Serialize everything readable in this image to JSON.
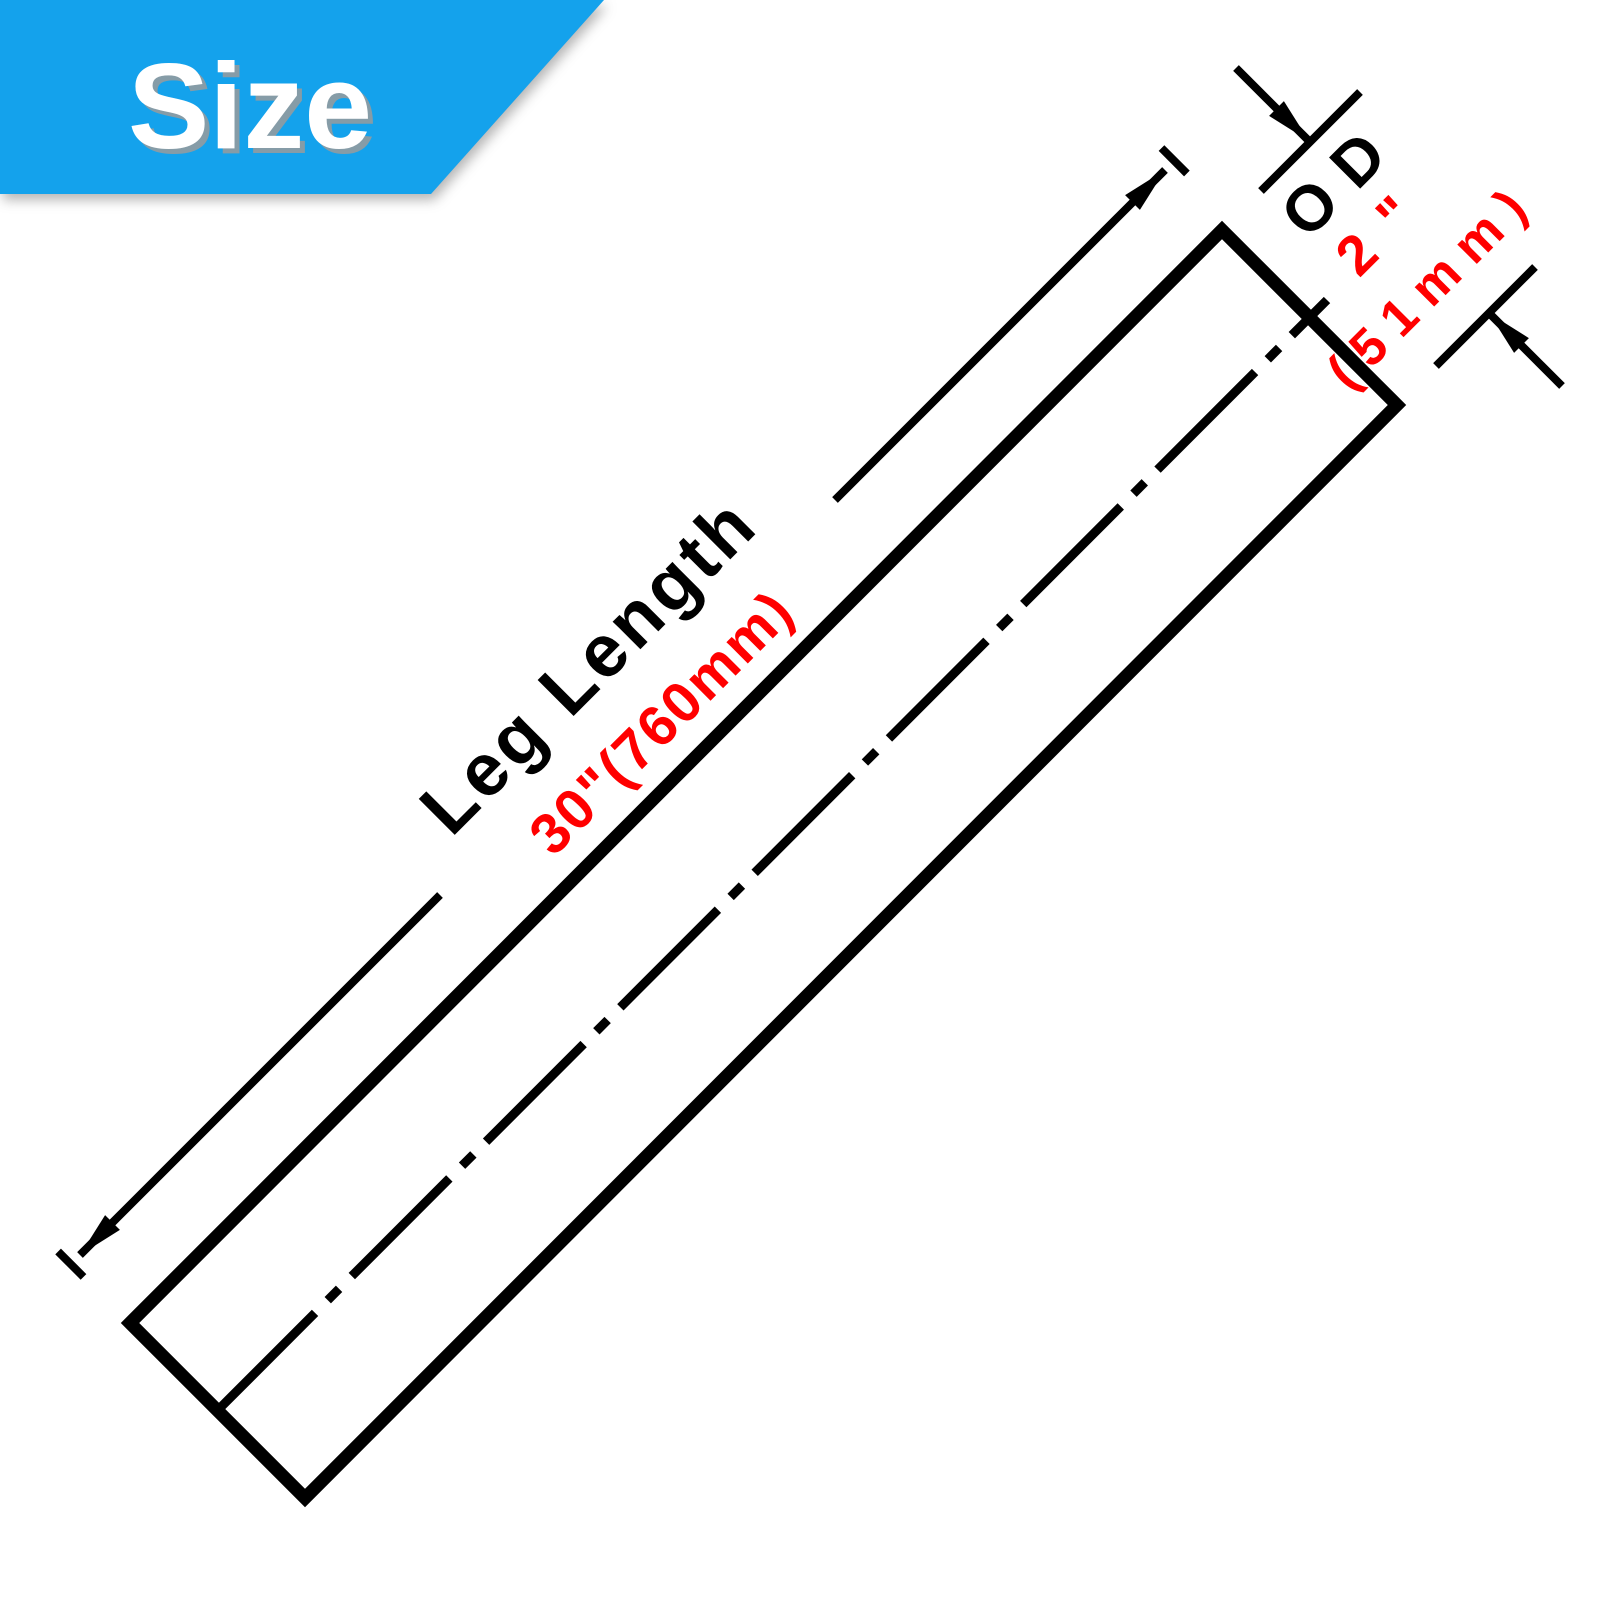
{
  "banner": {
    "label": "Size",
    "background_color": "#14a2ec",
    "text_color": "#ffffff"
  },
  "diagram": {
    "leg_length": {
      "label": "Leg Length",
      "value": "30\"(760mm)"
    },
    "od": {
      "label": "OD",
      "value_inches": "2\"",
      "value_mm": "(51mm)"
    },
    "colors": {
      "outline": "#000000",
      "value_text": "#ff0000"
    }
  }
}
